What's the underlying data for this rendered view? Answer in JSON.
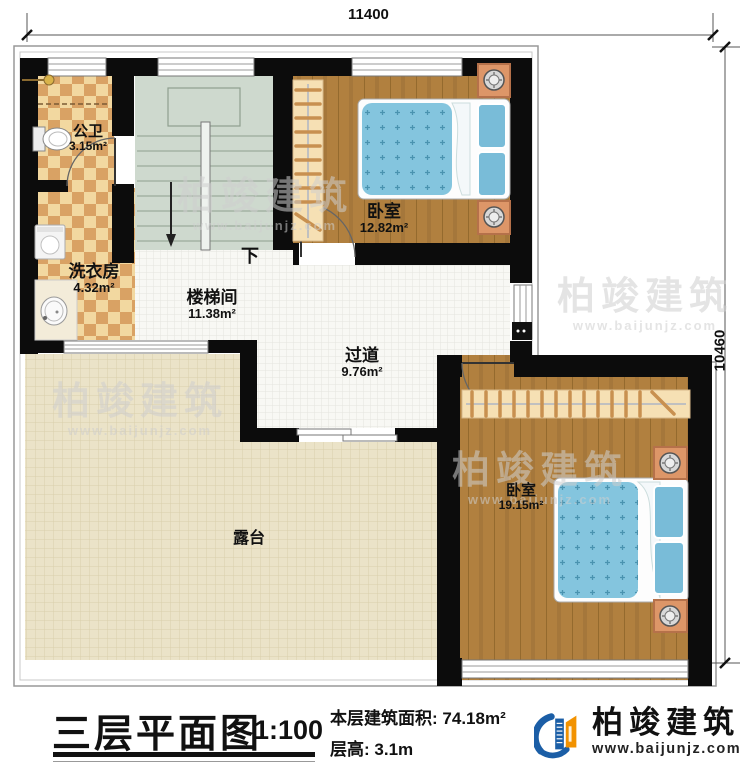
{
  "dimensions": {
    "top": "11400",
    "right": "10460"
  },
  "rooms": [
    {
      "id": "bathroom",
      "name": "公卫",
      "area": "3.15m²"
    },
    {
      "id": "laundry",
      "name": "洗衣房",
      "area": "4.32m²"
    },
    {
      "id": "stairwell",
      "name": "楼梯间",
      "area": "11.38m²"
    },
    {
      "id": "bedroom-top",
      "name": "卧室",
      "area": "12.82m²"
    },
    {
      "id": "hallway",
      "name": "过道",
      "area": "9.76m²"
    },
    {
      "id": "bedroom-right",
      "name": "卧室",
      "area": "19.15m²"
    },
    {
      "id": "terrace",
      "name": "露台",
      "area": ""
    }
  ],
  "stairs": {
    "direction_label": "下"
  },
  "title_block": {
    "title": "三层平面图",
    "scale": "1:100",
    "floor_area_label": "本层建筑面积:",
    "floor_area_value": "74.18m²",
    "floor_height_label": "层高:",
    "floor_height_value": "3.1m"
  },
  "brand": {
    "name": "柏竣建筑",
    "website": "www.baijunjz.com"
  },
  "watermark": {
    "text": "柏竣建筑",
    "website": "www.baijunjz.com"
  },
  "colors": {
    "wall": "#0c0c0c",
    "wood_floor": "#b1803f",
    "mattress_blue": "#84c5de",
    "checker_light": "#f2d8a0",
    "checker_dark": "#d9a264",
    "terrace_tile": "#ebe3c8",
    "stair_floor": "#ced9ce",
    "hall_tile": "#f8f8f4",
    "wardrobe": "#f6e0b4",
    "brand_blue": "#1b5ea6",
    "brand_orange": "#f29200"
  }
}
